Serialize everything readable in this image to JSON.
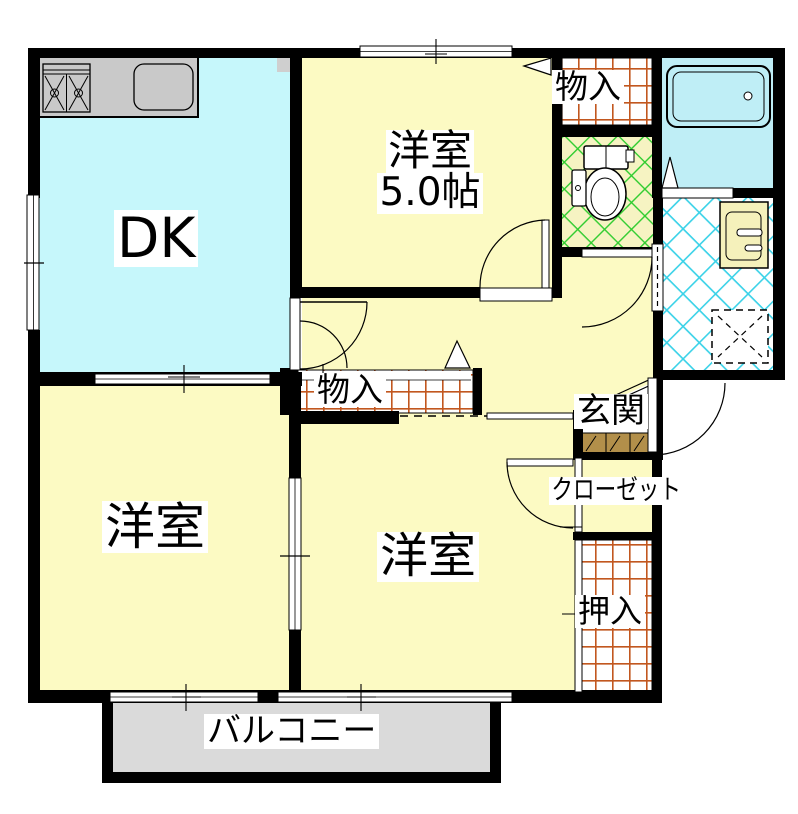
{
  "floorplan": {
    "labels": {
      "dk": "DK",
      "bedroom_top": "洋室",
      "bedroom_top_size": "5.0帖",
      "storage_top": "物入",
      "storage_hall": "物入",
      "entrance": "玄関",
      "closet": "クローゼット",
      "oshiire": "押入",
      "bedroom_left": "洋室",
      "bedroom_center": "洋室",
      "balcony": "バルコニー"
    },
    "colors": {
      "wall": "#000000",
      "roomYellow": "#fcfac3",
      "dkCyan": "#c6f7fb",
      "bathCyan": "#bfeef6",
      "toiletYellow": "#f6f3c2",
      "balconyGray": "#dadada",
      "counterGray": "#c9c9c9",
      "gridOrange": "#c2571f",
      "latticeGreen": "#2ecc2e",
      "latticeCyan": "#3ad2e8",
      "stepBrown": "#b28f4a",
      "basinYellow": "#f5f1bb",
      "pillarGray": "#cfcfcf"
    }
  }
}
